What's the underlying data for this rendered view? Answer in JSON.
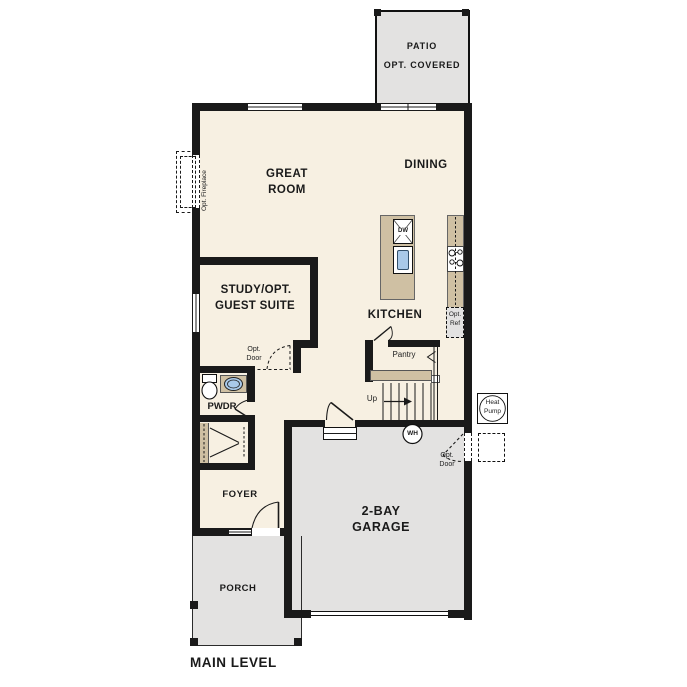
{
  "plan": {
    "colors": {
      "wall": "#1a1a1a",
      "floor": "#f7f0e2",
      "concrete": "#e3e2e1",
      "cabinet": "#cfc0a3",
      "sink_blue": "#a9c9e9"
    },
    "rooms": {
      "patio": {
        "name": "PATIO",
        "note": "OPT. COVERED"
      },
      "great_room": {
        "line1": "GREAT",
        "line2": "ROOM"
      },
      "dining": {
        "name": "DINING"
      },
      "kitchen": {
        "name": "KITCHEN"
      },
      "study": {
        "line1": "STUDY/OPT.",
        "line2": "GUEST SUITE"
      },
      "pantry": {
        "name": "Pantry"
      },
      "pwdr": {
        "name": "PWDR"
      },
      "foyer": {
        "name": "FOYER"
      },
      "garage": {
        "line1": "2-BAY",
        "line2": "GARAGE"
      },
      "porch": {
        "name": "PORCH"
      }
    },
    "labels": {
      "up": "Up",
      "wh": "WH",
      "dw": "DW",
      "heat_pump": {
        "line1": "Heat",
        "line2": "Pump"
      },
      "opt_ref": {
        "line1": "Opt.",
        "line2": "Ref"
      },
      "opt_door": {
        "line1": "Opt.",
        "line2": "Door"
      },
      "opt_fireplace": "Opt. Fireplace",
      "level": "MAIN LEVEL"
    }
  }
}
